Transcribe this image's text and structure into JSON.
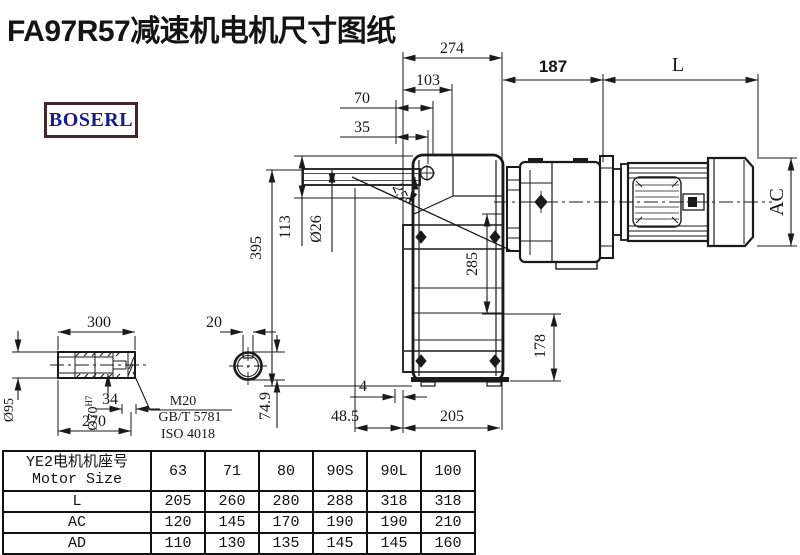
{
  "title": "FA97R57减速机电机尺寸图纸",
  "logo": {
    "text": "BOSERL"
  },
  "colors": {
    "line": "#1a1a1a",
    "logo_text": "#19198f",
    "logo_border": "#40282a"
  },
  "drawing": {
    "dim_labels": {
      "width_274": "274",
      "width_103": "103",
      "width_70": "70",
      "width_35": "35",
      "dist_187": "187",
      "motor_length": "L",
      "height_395": "395",
      "height_113": "113",
      "shaft_dia": "Ø26",
      "angle_25": "25°",
      "flange_285": "285",
      "height_178": "178",
      "offset_4": "4",
      "offset_48_5": "48.5",
      "base_205": "205",
      "motor_dia": "AC"
    },
    "shaft_detail": {
      "length_300": "300",
      "length_270": "270",
      "depth_34": "34",
      "outer_dia": "Ø95",
      "bore_dia": "Ø70",
      "bore_tol": "H7"
    },
    "key_detail": {
      "key_width": "20",
      "key_height": "74.9"
    },
    "callout": {
      "line1": "M20",
      "line2": "GB/T 5781",
      "line3": "ISO 4018"
    }
  },
  "table": {
    "header_cn": "YE2电机机座号",
    "header_en": "Motor Size",
    "sizes": [
      "63",
      "71",
      "80",
      "90S",
      "90L",
      "100"
    ],
    "rows": [
      {
        "label": "L",
        "values": [
          "205",
          "260",
          "280",
          "288",
          "318",
          "318"
        ]
      },
      {
        "label": "AC",
        "values": [
          "120",
          "145",
          "170",
          "190",
          "190",
          "210"
        ]
      },
      {
        "label": "AD",
        "values": [
          "110",
          "130",
          "135",
          "145",
          "145",
          "160"
        ]
      }
    ]
  }
}
